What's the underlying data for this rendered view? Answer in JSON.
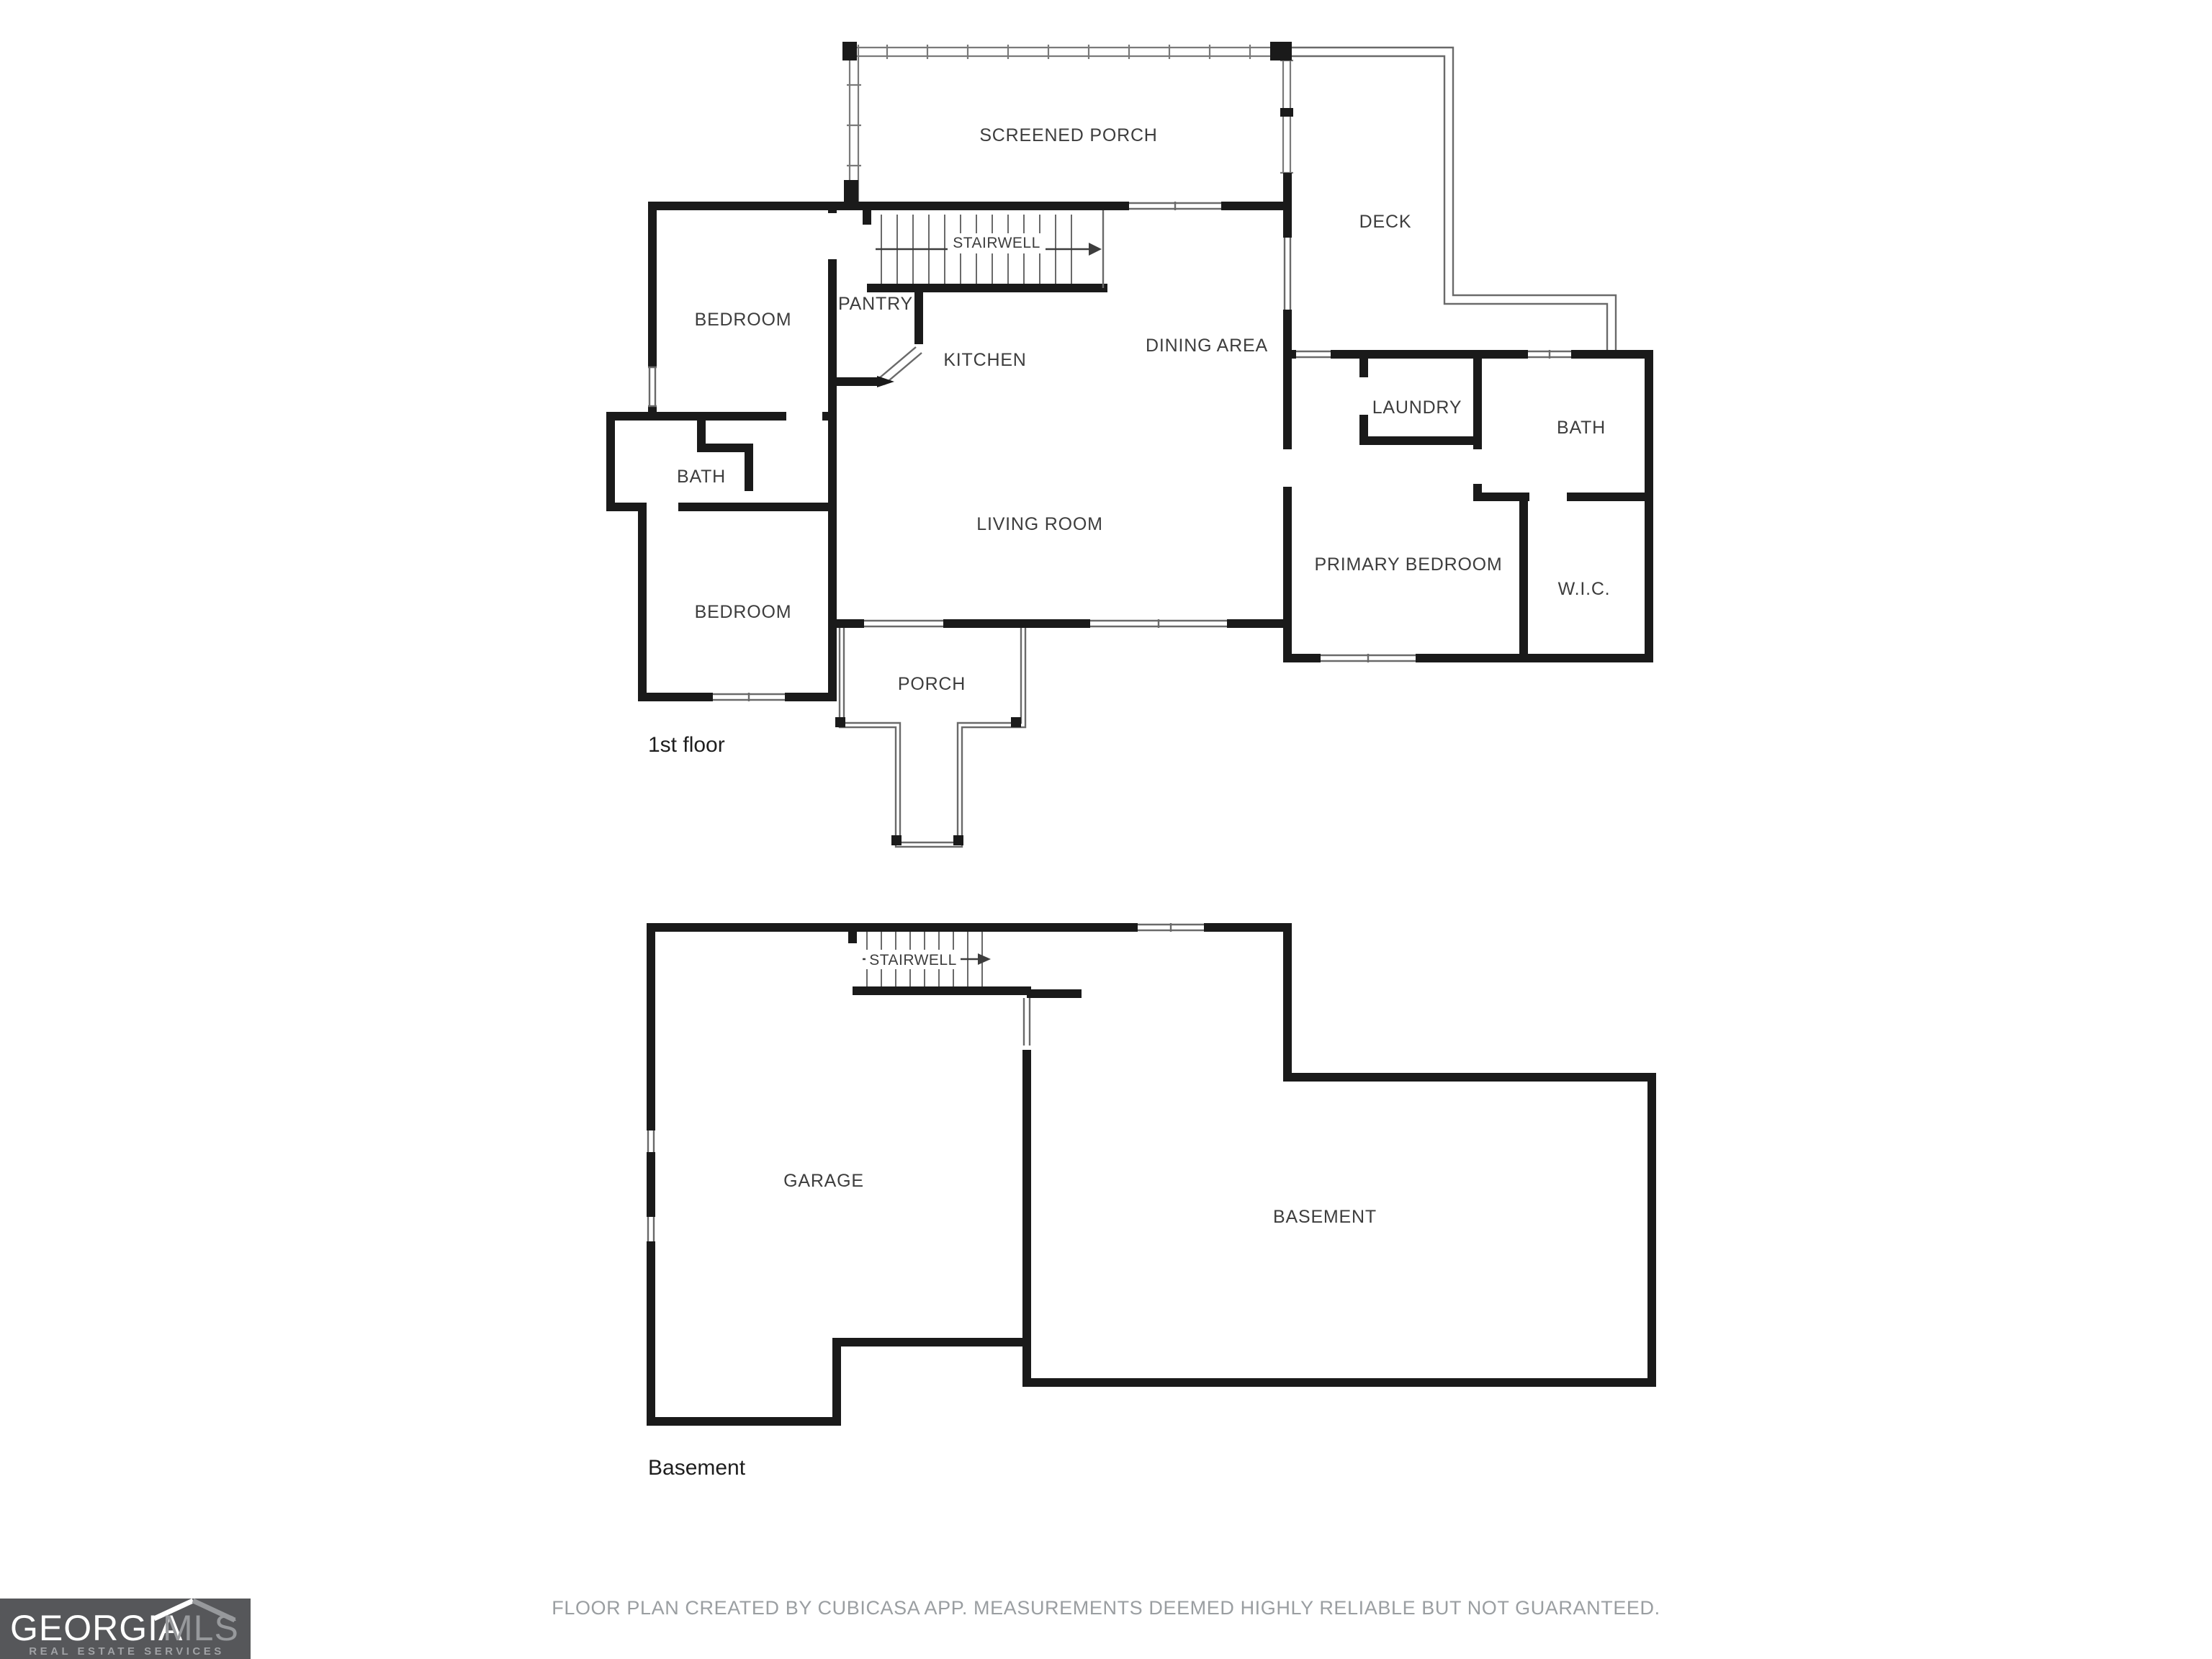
{
  "document": {
    "type": "floor-plan",
    "floors": [
      "1st floor",
      "Basement"
    ]
  },
  "first_floor": {
    "floor_label": "1st floor",
    "rooms": {
      "screened_porch": "SCREENED PORCH",
      "deck": "DECK",
      "stairwell": "STAIRWELL",
      "pantry": "PANTRY",
      "kitchen": "KITCHEN",
      "dining_area": "DINING AREA",
      "living_room": "LIVING ROOM",
      "bedroom_top": "BEDROOM",
      "bath_left": "BATH",
      "bedroom_bottom": "BEDROOM",
      "laundry": "LAUNDRY",
      "bath_right": "BATH",
      "primary_bedroom": "PRIMARY BEDROOM",
      "wic": "W.I.C.",
      "porch": "PORCH"
    }
  },
  "basement_floor": {
    "floor_label": "Basement",
    "rooms": {
      "stairwell": "STAIRWELL",
      "garage": "GARAGE",
      "basement": "BASEMENT"
    }
  },
  "footer": {
    "disclaimer": "FLOOR PLAN CREATED BY CUBICASA APP. MEASUREMENTS DEEMED HIGHLY RELIABLE BUT NOT GUARANTEED."
  },
  "logo": {
    "brand_primary": "GEORGIA",
    "brand_secondary": "MLS",
    "tagline": "REAL ESTATE SERVICES"
  },
  "colors": {
    "wall": "#1a1a1a",
    "thin_line": "#6a6a6a",
    "screen_line": "#7a7a7a",
    "room_label": "#3d3d3d",
    "floor_label": "#1e1e1e",
    "disclaimer": "#9a9ea1",
    "logo_bg": "#56575a",
    "logo_primary": "#ffffff",
    "logo_secondary": "#97999c",
    "logo_tagline": "#a0a2a5"
  }
}
